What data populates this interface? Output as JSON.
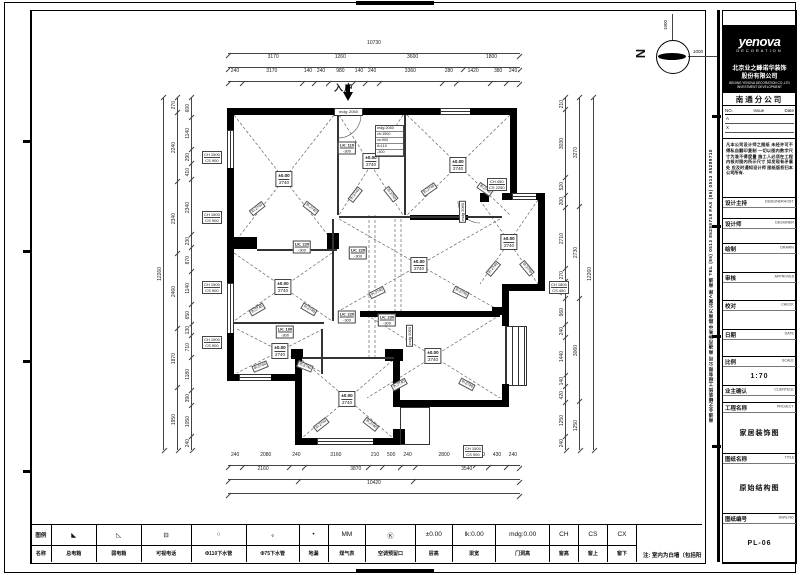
{
  "north": {
    "letter": "N",
    "dim_up": "1000",
    "dim_right": "1000"
  },
  "entry": {
    "label": "入户",
    "mdg": "mdg: 2060"
  },
  "plan": {
    "room_labels": [
      {
        "l1": "±0.00",
        "l2": "2740",
        "style": "left:87px;top:86px"
      },
      {
        "l1": "±0.00",
        "l2": "2740",
        "style": "left:174px;top:68px"
      },
      {
        "l1": "±0.00",
        "l2": "2740",
        "style": "left:261px;top:72px"
      },
      {
        "l1": "±0.00",
        "l2": "2740",
        "style": "left:312px;top:149px"
      },
      {
        "l1": "±0.00",
        "l2": "2740",
        "style": "left:222px;top:172px"
      },
      {
        "l1": "±0.00",
        "l2": "2740",
        "style": "left:86px;top:194px"
      },
      {
        "l1": "±0.00",
        "l2": "2740",
        "style": "left:83px;top:258px"
      },
      {
        "l1": "±0.00",
        "l2": "2740",
        "style": "left:150px;top:306px"
      },
      {
        "l1": "±0.00",
        "l2": "2740",
        "style": "left:236px;top:263px"
      }
    ],
    "lk_tags": [
      {
        "l1": "LK: 110",
        "l2": "-300",
        "style": "left:150px;top:55px"
      },
      {
        "l1": "LK: 220",
        "l2": "-300",
        "style": "left:105px;top:154px"
      },
      {
        "l1": "LK: 220",
        "l2": "-300",
        "style": "left:161px;top:160px"
      },
      {
        "l1": "LK: 220",
        "l2": "-300",
        "style": "left:150px;top:224px"
      },
      {
        "l1": "LK: 230",
        "l2": "-300",
        "style": "left:190px;top:227px"
      },
      {
        "l1": "LK: 190",
        "l2": "-300",
        "style": "left:88px;top:239px"
      }
    ],
    "window_tags": [
      {
        "l1": "CH 1500",
        "l2": "CS 900",
        "style": "left:5px;top:58px"
      },
      {
        "l1": "CH 1500",
        "l2": "CS 900",
        "style": "left:5px;top:118px"
      },
      {
        "l1": "CH 1500",
        "l2": "CS 900",
        "style": "left:5px;top:188px"
      },
      {
        "l1": "CH 1500",
        "l2": "CS 900",
        "style": "left:5px;top:243px"
      },
      {
        "l1": "CH 1800",
        "l2": "CS 450",
        "style": "left:352px;top:188px"
      },
      {
        "l1": "CH 1500",
        "l2": "CS 900",
        "style": "left:266px;top:352px"
      },
      {
        "l1": "CH 450",
        "l2": "CS 2250",
        "style": "left:290px;top:85px"
      }
    ],
    "mdg_tags": [
      {
        "text": "mdg 2060",
        "style": "left:262px;top:108px"
      },
      {
        "text": "mdg 2060",
        "style": "left:209px;top:232px"
      }
    ],
    "note_lines": [
      "mdg:2060",
      "ch:1500",
      "cs:900",
      "lk:110",
      "-300"
    ],
    "arm_labels": [
      {
        "text": "lh:2740",
        "style": "left:52px;top:112px;transform:rotate(-38deg)"
      },
      {
        "text": "lh:2740",
        "style": "left:106px;top:112px;transform:rotate(38deg)"
      },
      {
        "text": "lh:2740",
        "style": "left:224px;top:93px;transform:rotate(-35deg)"
      },
      {
        "text": "lh:2740",
        "style": "left:280px;top:93px;transform:rotate(35deg)"
      },
      {
        "text": "lh:2740",
        "style": "left:150px;top:98px;transform:rotate(-52deg)"
      },
      {
        "text": "lh:2740",
        "style": "left:186px;top:98px;transform:rotate(52deg)"
      },
      {
        "text": "lh:2740",
        "style": "left:172px;top:196px;transform:rotate(-26deg)"
      },
      {
        "text": "lh:2740",
        "style": "left:256px;top:196px;transform:rotate(26deg)"
      },
      {
        "text": "lh:2740",
        "style": "left:52px;top:213px;transform:rotate(-30deg)"
      },
      {
        "text": "lh:2740",
        "style": "left:104px;top:213px;transform:rotate(30deg)"
      },
      {
        "text": "lh:2740",
        "style": "left:55px;top:270px;transform:rotate(-22deg)"
      },
      {
        "text": "lh:2740",
        "style": "left:100px;top:270px;transform:rotate(22deg)"
      },
      {
        "text": "lh:2740",
        "style": "left:116px;top:328px;transform:rotate(-38deg)"
      },
      {
        "text": "lh:2740",
        "style": "left:166px;top:328px;transform:rotate(38deg)"
      },
      {
        "text": "lh:2740",
        "style": "left:194px;top:288px;transform:rotate(-28deg)"
      },
      {
        "text": "lh:2740",
        "style": "left:262px;top:288px;transform:rotate(28deg)"
      },
      {
        "text": "lh:2740",
        "style": "left:288px;top:172px;transform:rotate(-50deg)"
      },
      {
        "text": "lh:2740",
        "style": "left:322px;top:172px;transform:rotate(50deg)"
      }
    ]
  },
  "dims": {
    "top": {
      "overall": [
        "10730"
      ],
      "mid": [
        "3170",
        "1260",
        "3600",
        "1800"
      ],
      "inner": [
        "240",
        "3170",
        "140",
        "240",
        "980",
        "140",
        "240",
        "3360",
        "280",
        "1420",
        "380",
        "240"
      ]
    },
    "bottom": {
      "inner": [
        "240",
        "2080",
        "240",
        "3160",
        "210",
        "500",
        "240",
        "2800",
        "280",
        "430",
        "240"
      ],
      "mid": [
        "2160",
        "3870",
        "3540"
      ],
      "overall": [
        "10420"
      ]
    },
    "left": {
      "overall": [
        "12260"
      ],
      "mid": [
        "270",
        "2240",
        "2340",
        "2460",
        "1870",
        "1950"
      ],
      "inner": [
        "600",
        "1140",
        "290",
        "410",
        "2340",
        "230",
        "870",
        "1140",
        "650",
        "130",
        "710",
        "1180",
        "390",
        "1050",
        "240"
      ]
    },
    "right": {
      "inner": [
        "210",
        "3030",
        "520",
        "200",
        "2710",
        "270",
        "460",
        "960",
        "240",
        "1440",
        "140",
        "420",
        "1250",
        "240"
      ],
      "mid": [
        "3270",
        "2730",
        "3060",
        "1250"
      ],
      "overall": [
        "12260"
      ]
    }
  },
  "legend": {
    "header_top": "图例",
    "header_bottom": "名称",
    "items": [
      {
        "sym": "◣",
        "name": "总电箱",
        "v": 1.6
      },
      {
        "sym": "◺",
        "name": "弱电箱",
        "v": 1.6
      },
      {
        "sym": "⊟",
        "name": "可视电话",
        "v": 1.6
      },
      {
        "sym": "○",
        "name": "Φ110下水管",
        "v": 1.5
      },
      {
        "sym": "∘",
        "name": "Φ75下水管",
        "v": 1.5
      },
      {
        "sym": "•",
        "name": "地漏",
        "v": 1.0
      },
      {
        "sym": "MM",
        "name": "煤气表",
        "v": 1.2
      },
      {
        "sym": "Ⓚ",
        "name": "空调预留口",
        "v": 1.3
      },
      {
        "sym": "±0.00",
        "name": "层高",
        "v": 1.1
      },
      {
        "sym": "lk:0.00",
        "name": "梁宽",
        "v": 1.3
      },
      {
        "sym": "mdg:0.00",
        "name": "门洞高",
        "v": 1.4
      },
      {
        "sym": "CH",
        "name": "窗高",
        "v": 1.0
      },
      {
        "sym": "CS",
        "name": "窗上",
        "v": 1.0
      },
      {
        "sym": "CX",
        "name": "窗下",
        "v": 1.0
      }
    ],
    "note": "注: 室内为白墙（包括阳台）建筑面积:120m²"
  },
  "titleblock": {
    "logo_line1": "yenova",
    "logo_line2": "DECORATION",
    "company_cn1": "北京业之峰诺华装饰",
    "company_cn2": "股份有限公司",
    "company_en1": "BEIJING YENOVA DECORATION CO.,LTD",
    "company_en2": "INVESTMENT DEVELOPMENT",
    "branch": "南通分公司",
    "rev": {
      "no": "NO.",
      "issue": "Issue",
      "date": "Date",
      "rows": [
        "A",
        "X"
      ]
    },
    "disclaimer": "凡本公司设计师之图纸 未经许可不得私自翻印复制 一切以图内数字尺寸为准不得度量 施工人必须在工程内核对图内所示尺寸 如发现有矛盾处 应及时通知设计师 图纸版权归本公司所有.",
    "fields": [
      {
        "cn": "设计主持",
        "en": "DESIGNERHOST",
        "val": "",
        "style": "height:20px"
      },
      {
        "cn": "设计师",
        "en": "DESIGNER",
        "val": "",
        "style": "height:24px"
      },
      {
        "cn": "绘制",
        "en": "DRAWN",
        "val": "",
        "style": "height:28px"
      },
      {
        "cn": "审核",
        "en": "APPROVED",
        "val": "",
        "style": "height:28px"
      },
      {
        "cn": "校对",
        "en": "CHECK",
        "val": "",
        "style": "height:28px"
      },
      {
        "cn": "日期",
        "en": "DATE",
        "val": "",
        "style": "height:26px"
      },
      {
        "cn": "比例",
        "en": "SCALE",
        "val": "1:70",
        "style": "height:28px"
      },
      {
        "cn": "业主确认",
        "en": "CLIENTELE",
        "val": "",
        "style": "height:16px"
      },
      {
        "cn": "工程名称",
        "en": "PROJECT",
        "val": "家居装饰图",
        "style": "height:50px"
      },
      {
        "cn": "图纸名称",
        "en": "TITLE",
        "val": "原始结构图",
        "style": "height:60px"
      },
      {
        "cn": "图纸编号",
        "en": "DWG.NO",
        "val": "PL-06",
        "style": "height:48px"
      }
    ]
  },
  "side_strip": "南通业之峰装饰工程有限公司  南通市钟秀中路南方公寓A座  南通  TEL (86) 0513 85289718  FAX (86) 0513 85289710"
}
